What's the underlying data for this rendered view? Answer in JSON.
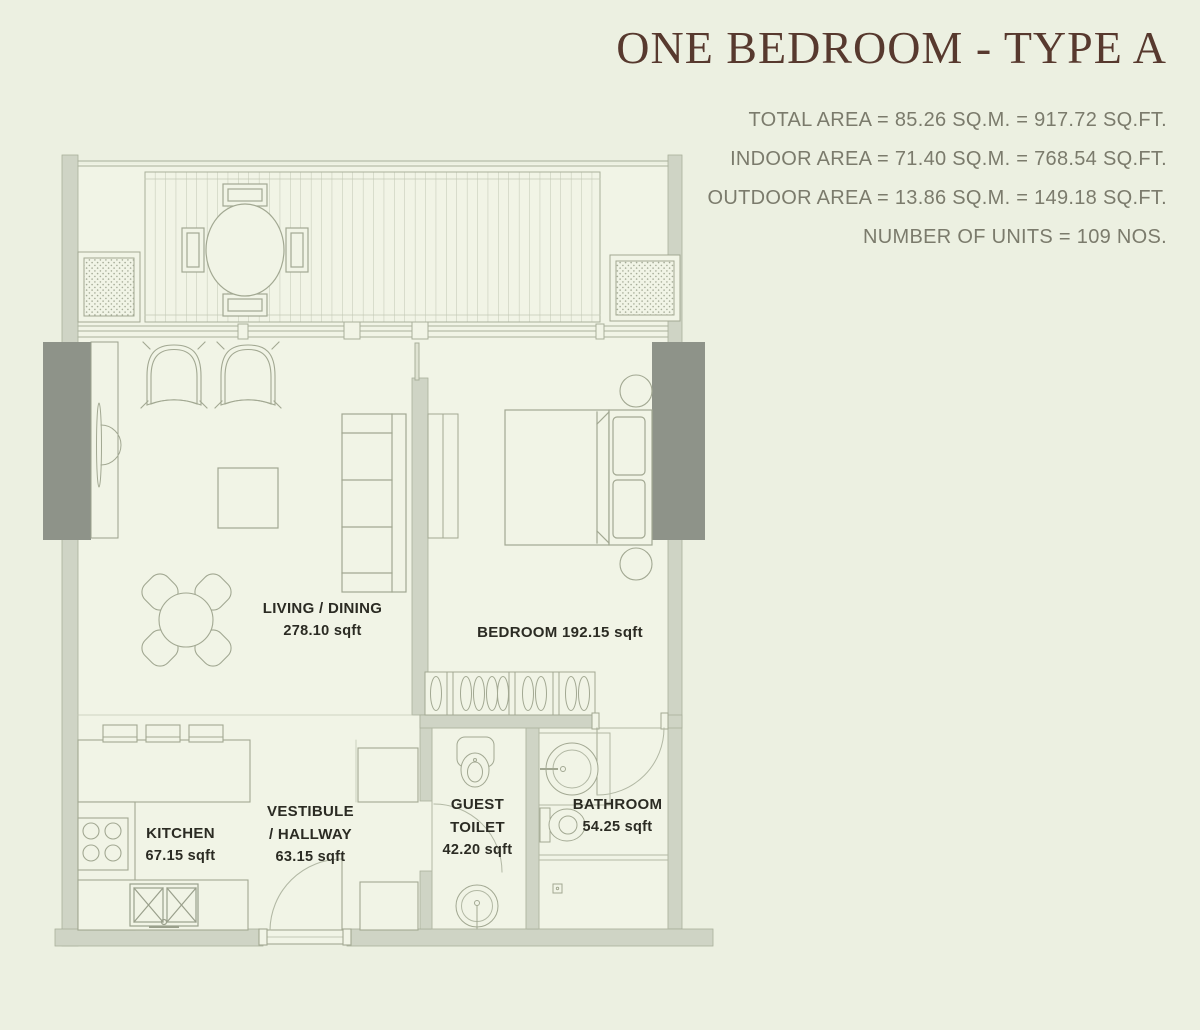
{
  "page": {
    "background": "#ecf0e1"
  },
  "header": {
    "title": "ONE BEDROOM - TYPE A",
    "title_color": "#57392e",
    "stats_color": "#7b7b6c",
    "stats": [
      "TOTAL AREA = 85.26 SQ.M. = 917.72 SQ.FT.",
      "INDOOR AREA = 71.40 SQ.M. = 768.54 SQ.FT.",
      "OUTDOOR AREA = 13.86 SQ.M. = 149.18 SQ.FT.",
      "NUMBER OF UNITS = 109 NOS."
    ]
  },
  "floor_plan": {
    "wall_color": "#cfd4c5",
    "wall_dark_color": "#8e9389",
    "line_color": "#a2a892",
    "floor_color": "#f1f4e6",
    "label_color": "#2b2b23",
    "labels": {
      "living": {
        "line1": "LIVING / DINING",
        "line2": "278.10 sqft"
      },
      "bedroom": {
        "line1": "BEDROOM 192.15 sqft"
      },
      "kitchen": {
        "line1": "KITCHEN",
        "line2": "67.15 sqft"
      },
      "vestibule": {
        "line1": "VESTIBULE",
        "line2": "/ HALLWAY",
        "line3": "63.15 sqft"
      },
      "guest_toilet": {
        "line1": "GUEST",
        "line2": "TOILET",
        "line3": "42.20 sqft"
      },
      "bathroom": {
        "line1": "BATHROOM",
        "line2": "54.25 sqft"
      }
    }
  }
}
